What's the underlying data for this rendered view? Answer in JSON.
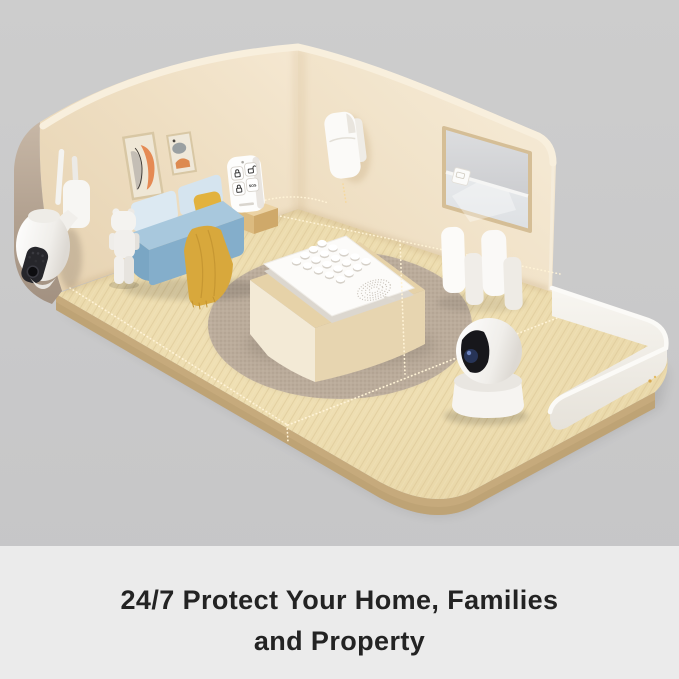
{
  "caption": {
    "line1": "24/7 Protect Your Home, Families",
    "line2": "and Property"
  },
  "keyfob": {
    "sos_label": "SOS",
    "buttons": [
      "arm-lock-icon",
      "disarm-unlock-icon",
      "home-arm-lock-icon",
      "sos-button"
    ]
  },
  "scene": {
    "objects": [
      "outdoor-ptz-camera",
      "pir-motion-sensor",
      "remote-keyfob",
      "keyfob-stand-block",
      "wall-art-frame-large",
      "wall-art-frame-small",
      "sofa",
      "throw-blanket",
      "pillow",
      "bear-figurine",
      "window-roller-shade",
      "shade-sensor",
      "door-window-sensor-pairs",
      "alarm-keypad-hub",
      "table-platform",
      "round-rug",
      "wood-floor",
      "glass-railing",
      "dashed-protection-lines"
    ],
    "colors": {
      "background": "#c9c9c9",
      "caption_band": "#ebebeb",
      "caption_text": "#232323",
      "wall_cream": "#efdfc4",
      "wall_outer_taupe": "#b1a190",
      "floor_wood": "#e9d8ab",
      "rug": "#c2b3a2",
      "sofa_blue": "#86b0cd",
      "pillow_yellow": "#e2b23e",
      "device_white": "#fafaf8",
      "dash_line": "#fff3d6"
    }
  }
}
